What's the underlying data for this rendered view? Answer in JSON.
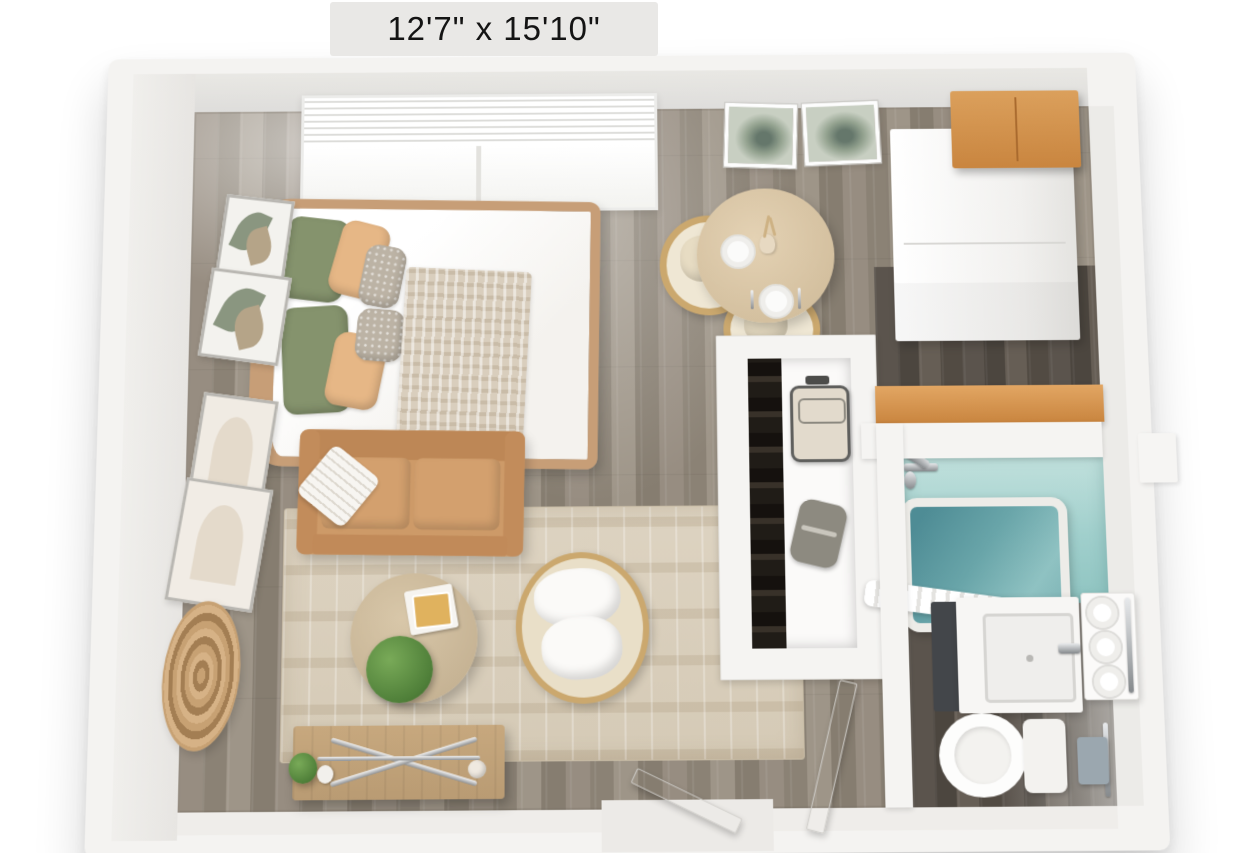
{
  "floorplan": {
    "size_label": "12'7\" x 15'10\""
  },
  "palette": {
    "background": "#ffffff",
    "wall": "#f4f3f1",
    "wall_face": "#e6e5e2",
    "floor_main": "#93897d",
    "floor_dark": "#57514b",
    "cabinet_wood": "#cd8f4f",
    "closet_shelf_wood": "#d79a55",
    "tub_tile": "#a9d4d2",
    "tub_water": "#69a5a9",
    "sofa_leather": "#cd9a68",
    "rug": "#d9cfbc",
    "table_wood": "#d8c5a5",
    "pillow_green": "#85936d",
    "pillow_tan": "#e6b786",
    "plant_green": "#4f7f39",
    "chrome": "#9aa0a4",
    "towel_blue_gray": "#9ba7af"
  },
  "inventory": {
    "bedroom": [
      "bed",
      "green-pillows",
      "tan-pillows",
      "patterned-pillows",
      "knit-throw",
      "window-with-blinds",
      "botanical-wall-art"
    ],
    "living": [
      "loveseat-sofa",
      "striped-throw-pillow",
      "area-rug",
      "round-coffee-table",
      "potted-plant",
      "books",
      "rattan-accent-chair",
      "media-console",
      "console-plant",
      "vase"
    ],
    "dining": [
      "round-dining-table",
      "rattan-dining-chair",
      "rattan-dining-chair",
      "place-settings",
      "table-centerpiece"
    ],
    "kitchenette": [
      "refrigerator",
      "wood-wall-cabinets"
    ],
    "closet": [
      "hanging-clothes",
      "suitcase",
      "duffel-bag",
      "wood-shelf"
    ],
    "bathroom": [
      "bathtub",
      "shower-fixtures",
      "shower-curtain",
      "vanity-sink",
      "towel-shelf",
      "rolled-towels",
      "toilet",
      "hand-towel"
    ],
    "doors": [
      "entry-door",
      "bathroom-door"
    ],
    "wall_decor": [
      "leaf-print",
      "succulent-print",
      "abstract-frame",
      "abstract-frame",
      "woven-round-mirror"
    ]
  }
}
